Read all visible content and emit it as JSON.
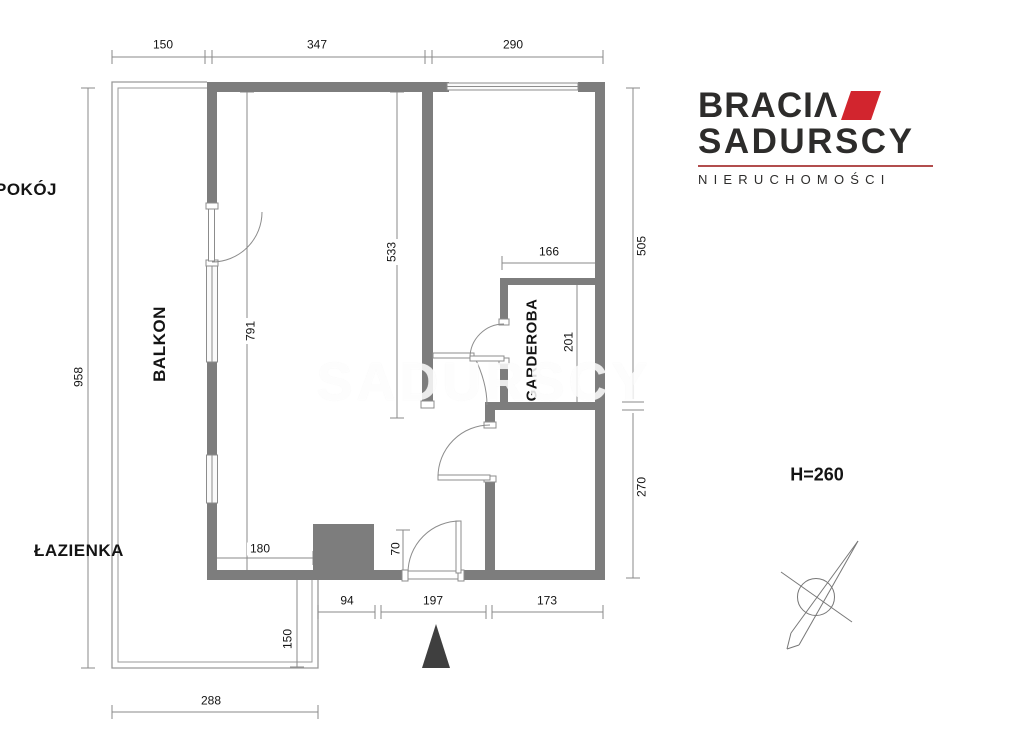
{
  "logo": {
    "line1": "BRACIΛ",
    "line2": "SADURSCY",
    "tagline": "NIERUCHOMOŚCI",
    "accent_color": "#d2252e",
    "text_color": "#2d2c2b"
  },
  "plan": {
    "height_note": "H=260",
    "watermark": "SADURSCY",
    "wall_color": "#7d7d7d",
    "rooms": {
      "salon": "SALON",
      "pokoj": "POKÓJ",
      "balkon": "BALKON",
      "kuchnia": "KUCHNIA",
      "garderoba": "GARDEROBA",
      "lazienka": "ŁAZIENKA"
    },
    "dims": {
      "top_left": "150",
      "top_mid": "347",
      "top_right": "290",
      "left_total": "958",
      "salon_height": "791",
      "divider": "533",
      "pokoj_height": "505",
      "garderoba_width": "166",
      "garderoba_height": "201",
      "lazienka_height": "270",
      "kitchen_wall": "180",
      "niche": "70",
      "balkon_lower": "150",
      "bottom_1": "94",
      "bottom_2": "197",
      "bottom_3": "173",
      "balkon_width": "288"
    }
  }
}
